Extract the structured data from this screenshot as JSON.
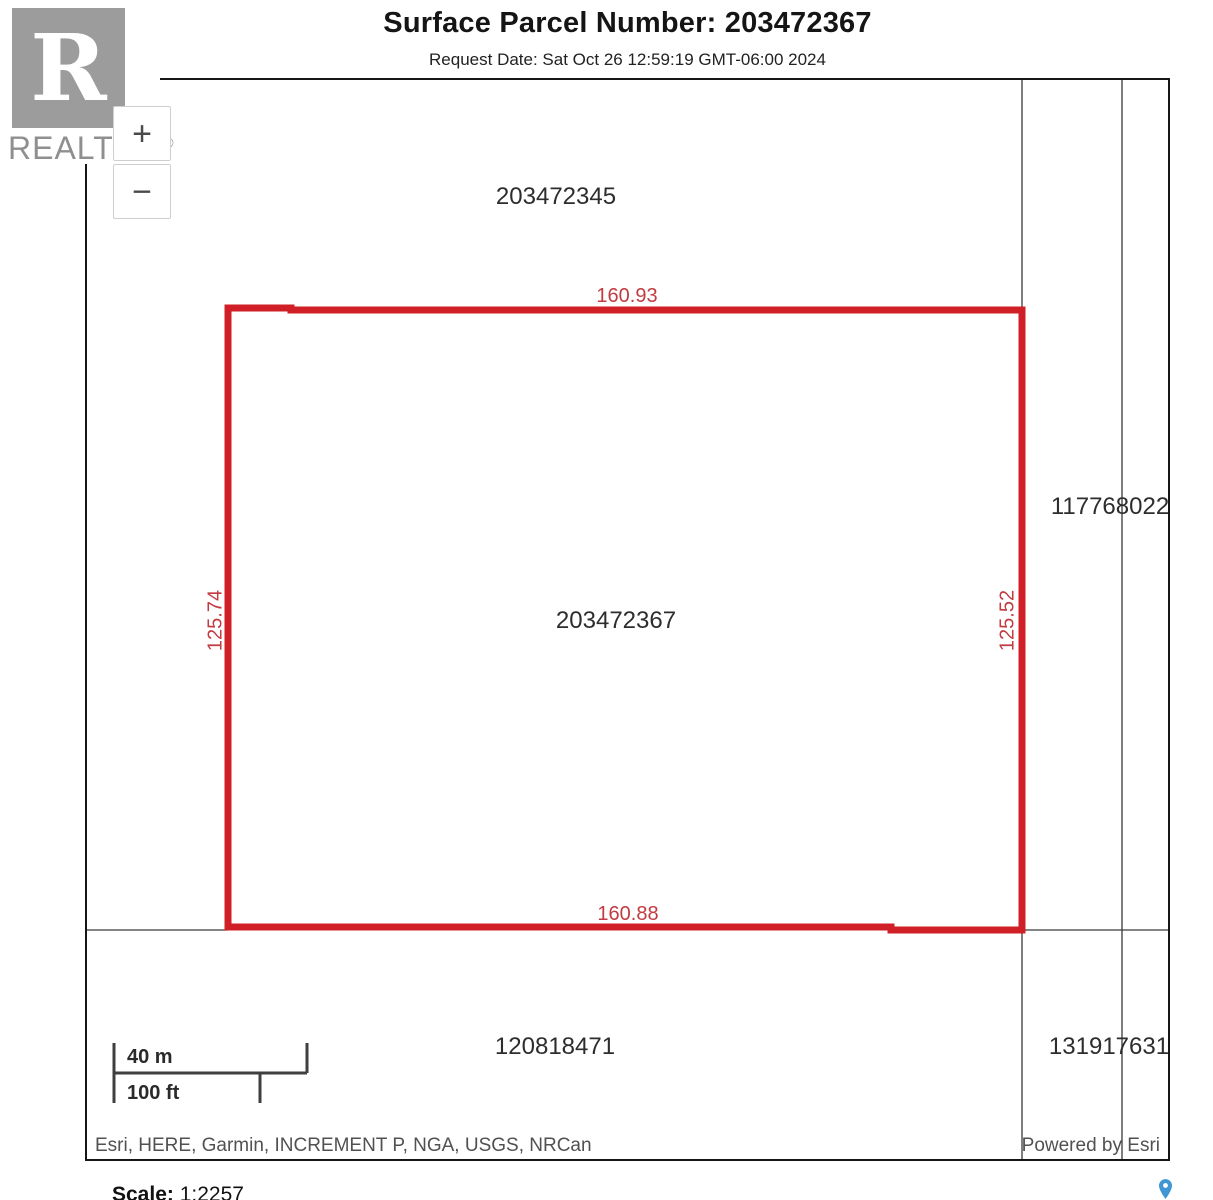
{
  "header": {
    "title": "Surface Parcel Number: 203472367",
    "request_date": "Request Date: Sat Oct 26 12:59:19 GMT-06:00 2024"
  },
  "logo": {
    "letter": "R",
    "brand": "REALTOR",
    "registered": "®"
  },
  "map_controls": {
    "zoom_in": "+",
    "zoom_out": "−"
  },
  "map": {
    "parcels": {
      "north": "203472345",
      "east": "117768022",
      "subject": "203472367",
      "south": "120818471",
      "southeast": "131917631"
    },
    "dimensions": {
      "top": "160.93",
      "bottom": "160.88",
      "left": "125.74",
      "right": "125.52"
    },
    "colors": {
      "parcel_outline": "#d01f26",
      "dimension_text": "#c23b40",
      "boundary_line": "#3a3a3a",
      "pin_blue": "#3f96d2"
    }
  },
  "scale_bar": {
    "metric": "40 m",
    "imperial": "100 ft"
  },
  "attribution": {
    "sources": "Esri, HERE, Garmin, INCREMENT P, NGA, USGS, NRCan",
    "powered_by": "Powered by Esri"
  },
  "footer": {
    "scale_label": "Scale:",
    "scale_value": "1:2257"
  }
}
